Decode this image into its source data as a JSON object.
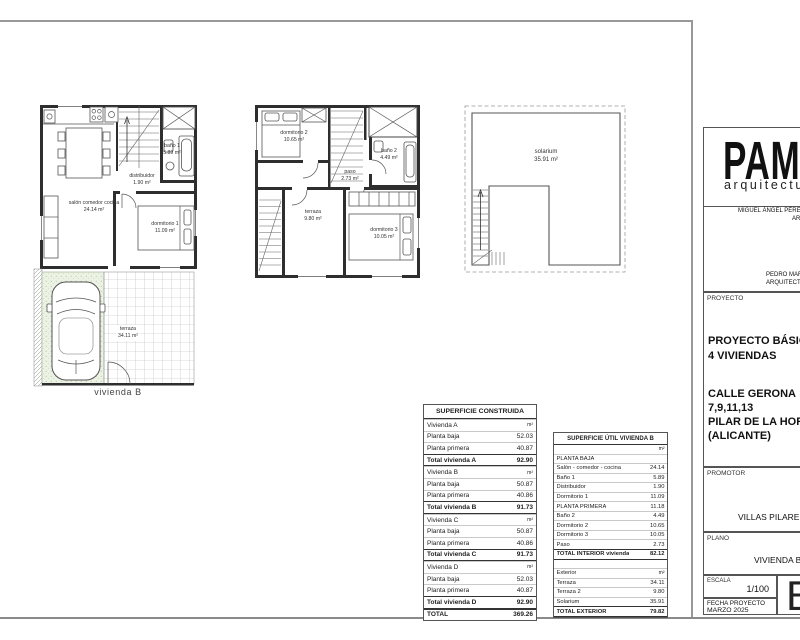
{
  "title_block": {
    "logo_text": "PAMI",
    "logo_sub": "arquitectura",
    "architect_1": "MIGUEL ÁNGEL PÉREZ",
    "architect_1b": "AR",
    "architect_2": "PEDRO MAR",
    "architect_2b": "ARQUITECTO",
    "proyecto_label": "PROYECTO",
    "proyecto_line1": "PROYECTO BÁSICO",
    "proyecto_line2": "4 VIVIENDAS",
    "address_line1": "CALLE GERONA",
    "address_line2": "7,9,11,13",
    "address_line3": "PILAR DE LA HORAD",
    "address_line4": "(ALICANTE)",
    "promotor_label": "PROMOTOR",
    "promotor_value": "VILLAS PILAREÑ",
    "plano_label": "PLANO",
    "plano_value": "VIVIENDA B",
    "escala_label": "ESCALA",
    "escala_value": "1/100",
    "fecha_label": "FECHA PROYECTO",
    "fecha_value": "MARZO 2025",
    "sheet_letter": "B"
  },
  "plans": {
    "ground": {
      "caption": "vivienda B",
      "labels": [
        {
          "name": "salón comedor cocina",
          "area": "24.14 m²"
        },
        {
          "name": "distribuidor",
          "area": "1.90 m²"
        },
        {
          "name": "baño 1",
          "area": "5.89 m²"
        },
        {
          "name": "dormitorio 1",
          "area": "11.09 m²"
        },
        {
          "name": "terraza",
          "area": "34.11 m²"
        }
      ]
    },
    "first": {
      "labels": [
        {
          "name": "dormitorio 2",
          "area": "10.65 m²"
        },
        {
          "name": "baño 2",
          "area": "4.49 m²"
        },
        {
          "name": "paso",
          "area": "2.73 m²"
        },
        {
          "name": "terraza",
          "area": "9.80 m²"
        },
        {
          "name": "dormitorio 3",
          "area": "10.05 m²"
        }
      ]
    },
    "solarium": {
      "labels": [
        {
          "name": "solarium",
          "area": "35.91 m²"
        }
      ]
    }
  },
  "tables": {
    "construida": {
      "title": "SUPERFICIE CONSTRUIDA",
      "rows": [
        {
          "label": "Vivienda A",
          "value": "m²",
          "style": "section"
        },
        {
          "label": "Planta baja",
          "value": "52.03",
          "style": "item"
        },
        {
          "label": "Planta primera",
          "value": "40.87",
          "style": "item"
        },
        {
          "label": "Total vivienda A",
          "value": "92.90",
          "style": "total"
        },
        {
          "label": "Vivienda B",
          "value": "m²",
          "style": "section"
        },
        {
          "label": "Planta baja",
          "value": "50.87",
          "style": "item"
        },
        {
          "label": "Planta primera",
          "value": "40.86",
          "style": "item"
        },
        {
          "label": "Total vivienda B",
          "value": "91.73",
          "style": "total"
        },
        {
          "label": "Vivienda C",
          "value": "m²",
          "style": "section"
        },
        {
          "label": "Planta baja",
          "value": "50.87",
          "style": "item"
        },
        {
          "label": "Planta primera",
          "value": "40.86",
          "style": "item"
        },
        {
          "label": "Total vivienda C",
          "value": "91.73",
          "style": "total"
        },
        {
          "label": "Vivienda D",
          "value": "m²",
          "style": "section"
        },
        {
          "label": "Planta baja",
          "value": "52.03",
          "style": "item"
        },
        {
          "label": "Planta primera",
          "value": "40.87",
          "style": "item"
        },
        {
          "label": "Total vivienda D",
          "value": "92.90",
          "style": "total"
        },
        {
          "label": "TOTAL",
          "value": "369.26",
          "style": "grand"
        }
      ]
    },
    "util": {
      "title": "SUPERFICIE ÚTIL VIVIENDA B",
      "rows": [
        {
          "label": "",
          "value": "m²",
          "style": "unit"
        },
        {
          "label": "PLANTA BAJA",
          "value": "",
          "style": "item"
        },
        {
          "label": "Salón - comedor - cocina",
          "value": "24.14",
          "style": "item"
        },
        {
          "label": "Baño 1",
          "value": "5.89",
          "style": "item"
        },
        {
          "label": "Distribuidor",
          "value": "1.90",
          "style": "item"
        },
        {
          "label": "Dormitorio 1",
          "value": "11.09",
          "style": "item"
        },
        {
          "label": "PLANTA PRIMERA",
          "value": "11.18",
          "style": "item"
        },
        {
          "label": "Baño 2",
          "value": "4.49",
          "style": "item"
        },
        {
          "label": "Dormitorio 2",
          "value": "10.65",
          "style": "item"
        },
        {
          "label": "Dormitorio 3",
          "value": "10.05",
          "style": "item"
        },
        {
          "label": "Paso",
          "value": "2.73",
          "style": "item"
        },
        {
          "label": "TOTAL INTERIOR vivienda",
          "value": "82.12",
          "style": "total"
        },
        {
          "label": "",
          "value": "",
          "style": "gap"
        },
        {
          "label": "Exterior",
          "value": "m²",
          "style": "unit2"
        },
        {
          "label": "Terraza",
          "value": "34.11",
          "style": "item"
        },
        {
          "label": "Terraza 2",
          "value": "9.80",
          "style": "item"
        },
        {
          "label": "Solarium",
          "value": "35.91",
          "style": "item"
        },
        {
          "label": "TOTAL EXTERIOR",
          "value": "79.82",
          "style": "total"
        }
      ]
    }
  }
}
